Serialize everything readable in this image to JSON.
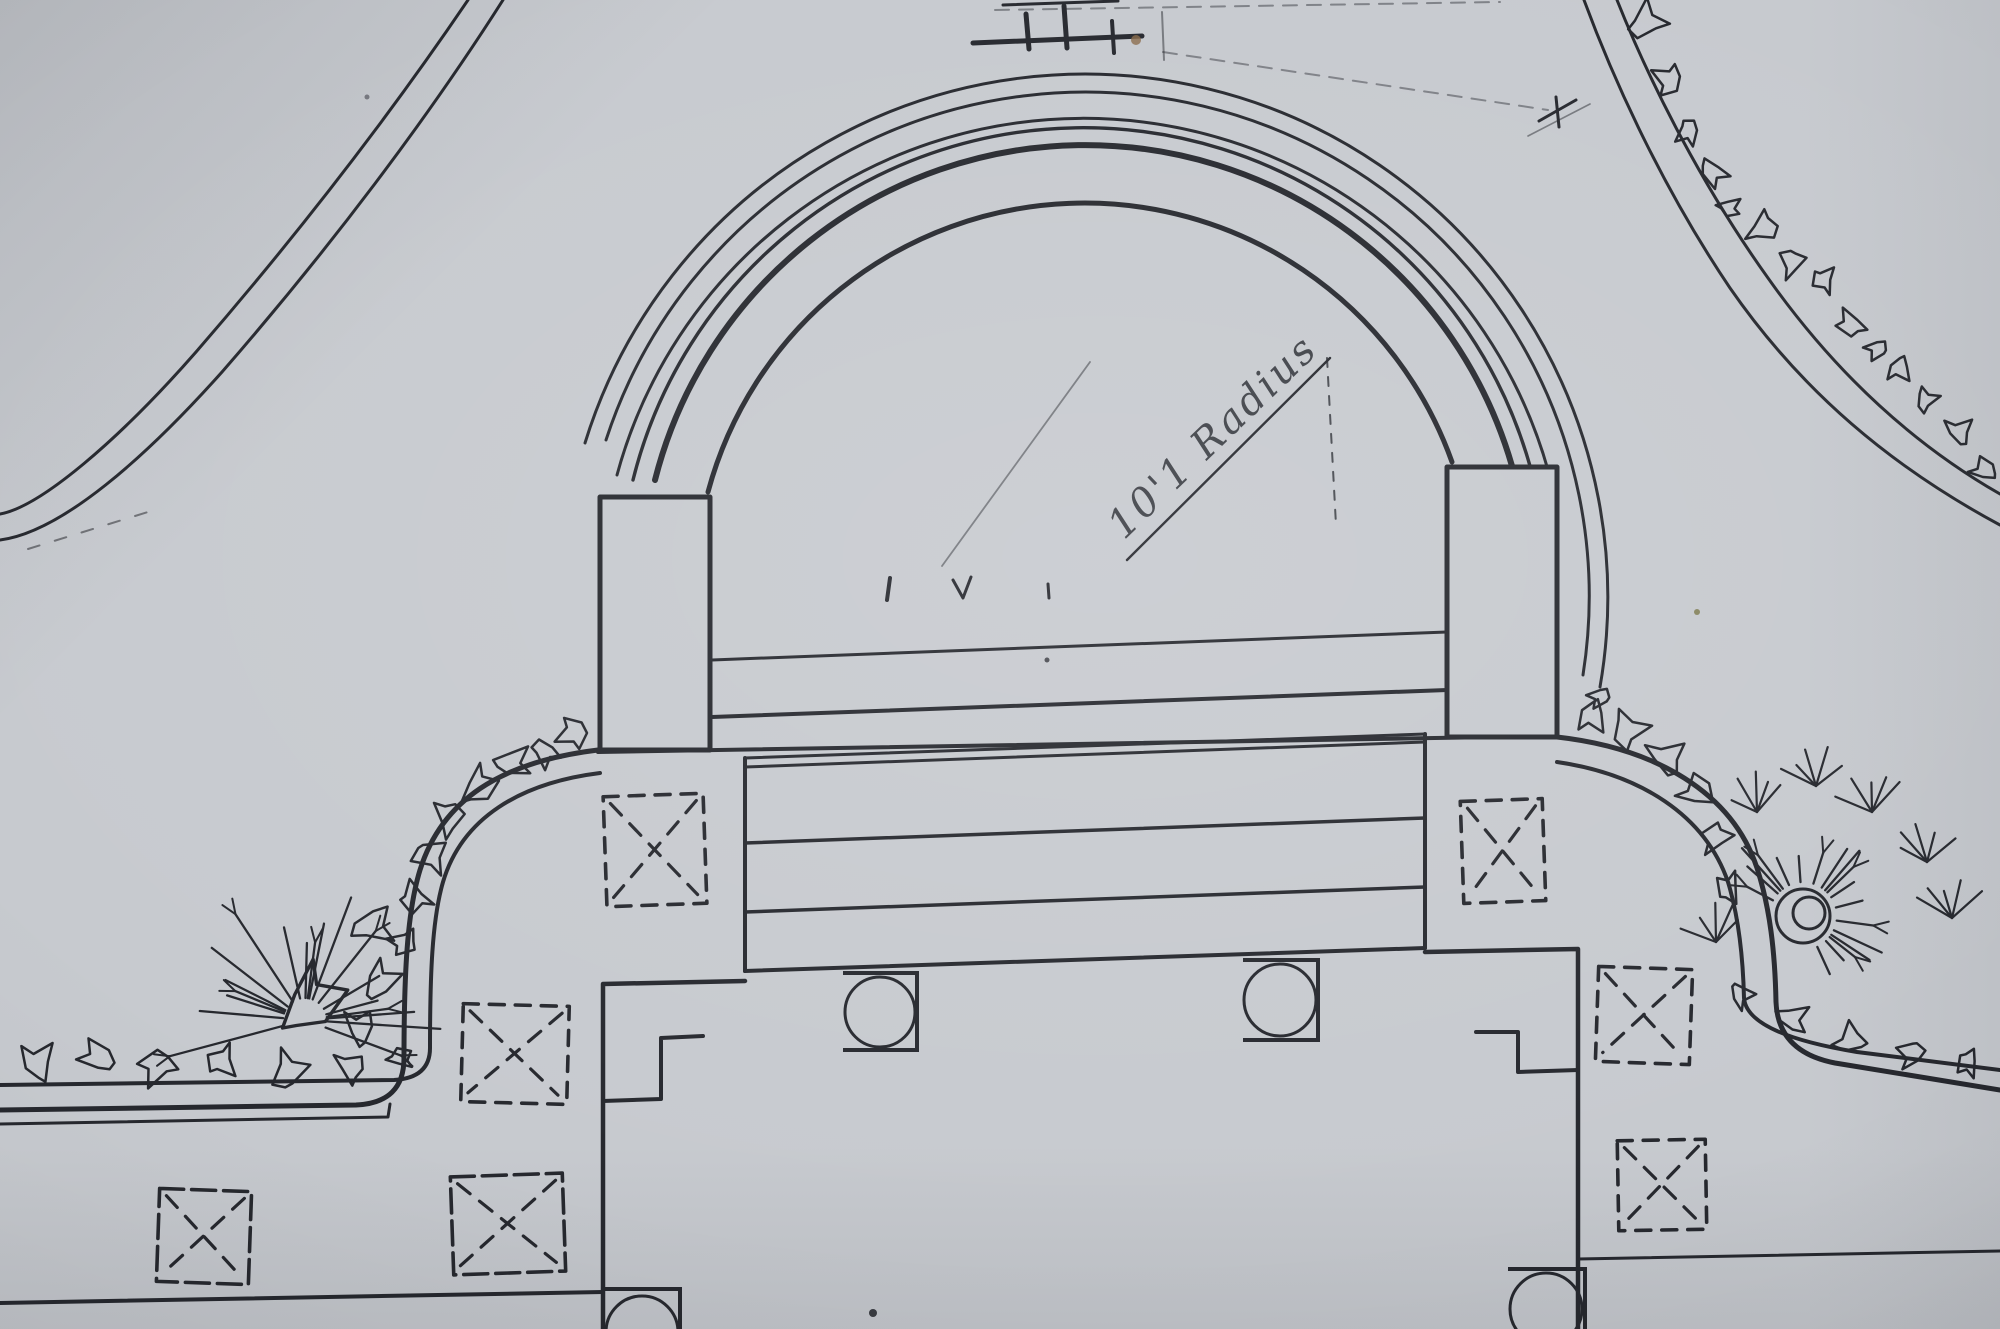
{
  "meta": {
    "description": "photograph of a hand-drawn landscape architecture site plan: semicircular amphitheater terrace with steps, pillars, curved walls, planting squares, boulders and shrubs",
    "paper_color": "#c7cacf",
    "ink_color": "#26282e",
    "thin_ink_color": "#33363d",
    "faint_ink_color": "#585c66",
    "smudge_color": "#8a6a4a",
    "olive_speck_color": "#7c7a4e"
  },
  "annotation": {
    "text": "10'1 Radius",
    "x": 1222,
    "y": 446,
    "rotation_deg": -44,
    "font_size": 40
  },
  "drawing": {
    "paths": [
      {
        "name": "swale-curve-outer",
        "d": "M 468,0 C 392,112 300,232 196,352 C 118,441 40,507 0,514",
        "w": 3
      },
      {
        "name": "swale-curve-inner",
        "d": "M 503,0 C 428,118 330,248 222,372 C 146,457 62,532 0,540",
        "w": 3
      },
      {
        "name": "swale-curve-dash",
        "d": "M 28,549 L 148,512",
        "w": 2,
        "dash": "12 16",
        "op": 0.55
      },
      {
        "name": "topright-path-outer",
        "d": "M 1617,0 C 1652,88 1705,190 1768,278 C 1838,377 1918,447 2000,494",
        "w": 3
      },
      {
        "name": "topright-path-inner",
        "d": "M 1584,0 C 1618,92 1668,196 1730,288 C 1802,392 1892,467 2000,525",
        "w": 3
      },
      {
        "name": "amphitheater-arc-1",
        "d": "M 585,443 A 523 523 0 0 1 1600,687",
        "w": 3
      },
      {
        "name": "amphitheater-arc-2",
        "d": "M 606,440 A 504 504 0 0 1 1583,675",
        "w": 3
      },
      {
        "name": "amphitheater-arc-3",
        "d": "M 617,475 A 483 483 0 0 1 1548,470",
        "w": 3
      },
      {
        "name": "amphitheater-arc-4",
        "d": "M 633,480 A 464 464 0 0 1 1530,466",
        "w": 3.4
      },
      {
        "name": "amphitheater-arc-5",
        "d": "M 655,480 A 444 444 0 0 1 1512,466",
        "w": 6
      },
      {
        "name": "amphitheater-arc-6",
        "d": "M 708,492 A 390 390 0 0 1 1452,462",
        "w": 5
      },
      {
        "name": "stage-front-edge",
        "d": "M 598,752 L 1557,736",
        "w": 4
      },
      {
        "name": "stage-step-line-1",
        "d": "M 712,660 L 1447,632",
        "w": 3
      },
      {
        "name": "stage-step-line-2",
        "d": "M 712,717 L 1447,690",
        "w": 4
      },
      {
        "name": "terrace-left-edge",
        "d": "M 745,758 L 745,971",
        "w": 4
      },
      {
        "name": "terrace-top-edge",
        "d": "M 745,758 L 1425,734",
        "w": 3
      },
      {
        "name": "terrace-right-edge",
        "d": "M 1425,734 L 1425,948",
        "w": 4
      },
      {
        "name": "terrace-bottom-edge",
        "d": "M 745,971 L 1425,948",
        "w": 4
      },
      {
        "name": "terrace-step-line-1",
        "d": "M 745,767 L 1425,742",
        "w": 3
      },
      {
        "name": "terrace-step-line-2",
        "d": "M 745,843 L 1425,818",
        "w": 3.5
      },
      {
        "name": "terrace-step-line-3",
        "d": "M 745,912 L 1425,887",
        "w": 3.5
      },
      {
        "name": "left-stepped-wall",
        "d": "M 745,981 L 603,984 L 603,1329",
        "w": 4.5
      },
      {
        "name": "left-wall-notch",
        "d": "M 703,1036 L 661,1038 L 661,1099 L 603,1101",
        "w": 4
      },
      {
        "name": "right-stepped-wall",
        "d": "M 1425,952 L 1578,949 L 1578,1329",
        "w": 4.5
      },
      {
        "name": "right-wall-notch",
        "d": "M 1476,1032 L 1518,1032 L 1518,1072 L 1578,1070",
        "w": 4
      },
      {
        "name": "left-curved-wall-outer",
        "d": "M 598,750 C 500,762 442,800 420,870 C 407,912 404,975 404,1058 Q 404,1103 356,1105 L 0,1110",
        "w": 5
      },
      {
        "name": "left-curved-wall-inner",
        "d": "M 600,773 C 520,783 462,818 443,882 C 432,920 430,975 430,1048 Q 430,1078 394,1080 L 0,1085",
        "w": 4
      },
      {
        "name": "right-curved-wall-outer",
        "d": "M 1557,737 C 1655,748 1732,792 1757,868 C 1770,908 1775,952 1776,1002 Q 1778,1052 1835,1063 L 2000,1090",
        "w": 5
      },
      {
        "name": "right-curved-wall-inner",
        "d": "M 1557,762 C 1640,774 1705,815 1728,882 C 1739,918 1743,957 1744,998 Q 1747,1034 1857,1052 L 2000,1070",
        "w": 4
      },
      {
        "name": "left-path-line",
        "d": "M 0,1124 L 388,1117 L 390,1104",
        "w": 3
      },
      {
        "name": "bottom-line-left",
        "d": "M 0,1303 L 603,1292",
        "w": 4
      },
      {
        "name": "bottom-line-right",
        "d": "M 1578,1259 L 2000,1251",
        "w": 3
      },
      {
        "name": "radius-leader-line",
        "d": "M 1127,560 L 1330,358",
        "w": 2.4
      },
      {
        "name": "radius-extension-dash",
        "d": "M 1327,358 L 1336,525",
        "w": 2,
        "dash": "9 10",
        "op": 0.8
      },
      {
        "name": "radius-construction-line",
        "d": "M 942,566 L 1090,362",
        "w": 1.8,
        "op": 0.5
      },
      {
        "name": "top-mark-bar",
        "d": "M 973,43 L 1142,36",
        "w": 5
      },
      {
        "name": "top-mark-tick-1",
        "d": "M 1026,14 L 1029,49",
        "w": 5
      },
      {
        "name": "top-mark-tick-2",
        "d": "M 1064,6 L 1067,48",
        "w": 5
      },
      {
        "name": "top-mark-tick-3",
        "d": "M 1112,21 L 1114,53",
        "w": 4
      },
      {
        "name": "top-mark-dash",
        "d": "M 1003,5 L 1118,1",
        "w": 3
      },
      {
        "name": "top-construction-dash-a",
        "d": "M 995,10 L 1500,2",
        "w": 2,
        "dash": "14 10",
        "op": 0.45
      },
      {
        "name": "top-construction-dash-b",
        "d": "M 1163,52 L 1548,110",
        "w": 2,
        "dash": "14 10",
        "op": 0.45
      },
      {
        "name": "top-construction-tick",
        "d": "M 1162,12 L 1164,60",
        "w": 2,
        "op": 0.5
      },
      {
        "name": "topright-cross-mark-1",
        "d": "M 1539,121 L 1576,100",
        "w": 3
      },
      {
        "name": "topright-cross-mark-2",
        "d": "M 1556,97 L 1559,127",
        "w": 3
      },
      {
        "name": "topright-cross-faint",
        "d": "M 1528,136 L 1590,104",
        "w": 1.6,
        "op": 0.5
      },
      {
        "name": "stage-tick-1",
        "d": "M 887,600 L 890,578",
        "w": 4
      },
      {
        "name": "stage-v-mark",
        "d": "M 953,580 L 963,598 L 971,577",
        "w": 3
      },
      {
        "name": "stage-tick-2",
        "d": "M 1048,584 L 1049,598",
        "w": 3
      }
    ],
    "pillars": [
      {
        "name": "left-pillar",
        "x": 600,
        "y": 497,
        "w": 110,
        "h": 253
      },
      {
        "name": "right-pillar",
        "x": 1447,
        "y": 467,
        "w": 110,
        "h": 270
      }
    ],
    "planters": [
      {
        "name": "planter-upper-left",
        "x": 605,
        "y": 795,
        "w": 100,
        "h": 110,
        "rot": -2,
        "style": "a"
      },
      {
        "name": "planter-lower-left",
        "x": 462,
        "y": 1005,
        "w": 106,
        "h": 98,
        "rot": 1.5,
        "style": "a"
      },
      {
        "name": "planter-upper-right",
        "x": 1462,
        "y": 800,
        "w": 82,
        "h": 102,
        "rot": -2,
        "style": "a"
      },
      {
        "name": "planter-mid-right",
        "x": 1597,
        "y": 968,
        "w": 94,
        "h": 95,
        "rot": 2,
        "style": "a"
      },
      {
        "name": "planter-lower-right",
        "x": 1618,
        "y": 1140,
        "w": 88,
        "h": 90,
        "rot": -1,
        "style": "a"
      },
      {
        "name": "planter-bottom-left-1",
        "x": 158,
        "y": 1190,
        "w": 92,
        "h": 93,
        "rot": 2,
        "style": "b"
      },
      {
        "name": "planter-bottom-left-2",
        "x": 452,
        "y": 1175,
        "w": 112,
        "h": 98,
        "rot": -2,
        "style": "b"
      }
    ],
    "columns": [
      {
        "name": "column-left",
        "sx": 843,
        "sy": 973,
        "sw": 74,
        "sh": 77,
        "cx": 880,
        "cy": 1012,
        "r": 35
      },
      {
        "name": "column-right",
        "sx": 1243,
        "sy": 960,
        "sw": 75,
        "sh": 80,
        "cx": 1280,
        "cy": 1000,
        "r": 36
      },
      {
        "name": "column-bottom-left",
        "sx": 604,
        "sy": 1289,
        "sw": 76,
        "sh": 52,
        "cx": 642,
        "cy": 1332,
        "r": 36
      },
      {
        "name": "column-bottom-right",
        "sx": 1508,
        "sy": 1269,
        "sw": 77,
        "sh": 64,
        "cx": 1546,
        "cy": 1309,
        "r": 36
      }
    ],
    "rock_groups": [
      {
        "name": "rocks-left-curve",
        "rocks": [
          [
            573,
            733,
            20
          ],
          [
            545,
            752,
            18
          ],
          [
            512,
            762,
            22
          ],
          [
            478,
            787,
            24
          ],
          [
            449,
            818,
            22
          ],
          [
            430,
            856,
            22
          ],
          [
            415,
            898,
            20
          ],
          [
            404,
            942,
            18
          ]
        ]
      },
      {
        "name": "rocks-left-inner",
        "rocks": [
          [
            372,
            926,
            26
          ],
          [
            380,
            982,
            24
          ],
          [
            360,
            1028,
            22
          ]
        ]
      },
      {
        "name": "rocks-left-bottom-row",
        "rocks": [
          [
            38,
            1062,
            24
          ],
          [
            98,
            1057,
            22
          ],
          [
            158,
            1066,
            24
          ],
          [
            222,
            1061,
            20
          ],
          [
            288,
            1071,
            24
          ],
          [
            350,
            1067,
            20
          ],
          [
            400,
            1058,
            15
          ]
        ]
      },
      {
        "name": "rocks-right-curve",
        "rocks": [
          [
            1600,
            697,
            14
          ],
          [
            1592,
            716,
            20
          ],
          [
            1628,
            730,
            24
          ],
          [
            1666,
            757,
            24
          ],
          [
            1697,
            792,
            22
          ],
          [
            1716,
            838,
            20
          ],
          [
            1729,
            888,
            18
          ]
        ]
      },
      {
        "name": "rocks-right-lower-band",
        "rocks": [
          [
            1741,
            995,
            16
          ],
          [
            1792,
            1018,
            20
          ],
          [
            1850,
            1040,
            20
          ],
          [
            1912,
            1054,
            18
          ],
          [
            1968,
            1063,
            16
          ]
        ]
      },
      {
        "name": "rocks-topright-chain",
        "rocks": [
          [
            1646,
            22,
            24
          ],
          [
            1669,
            80,
            20
          ],
          [
            1688,
            132,
            16
          ],
          [
            1713,
            172,
            18
          ],
          [
            1729,
            207,
            14
          ],
          [
            1762,
            228,
            20
          ],
          [
            1792,
            263,
            18
          ],
          [
            1824,
            280,
            16
          ],
          [
            1851,
            324,
            18
          ],
          [
            1877,
            349,
            14
          ],
          [
            1899,
            369,
            16
          ],
          [
            1926,
            400,
            15
          ],
          [
            1959,
            431,
            18
          ],
          [
            1984,
            470,
            16
          ]
        ]
      }
    ],
    "shrubs": [
      {
        "name": "shrub-left",
        "cx": 305,
        "cy": 1020,
        "blob_r": 42,
        "blob_dx": 5,
        "blob_dy": -18,
        "rays": {
          "n": 19,
          "a0": -195,
          "a1": 25,
          "r0": 22,
          "r1": 140
        },
        "circles": []
      },
      {
        "name": "shrub-right",
        "cx": 1803,
        "cy": 916,
        "blob_r": 0,
        "rays": {
          "n": 18,
          "a0": -160,
          "a1": 70,
          "r0": 34,
          "r1": 92
        },
        "circles": [
          27,
          16
        ],
        "tufts": [
          [
            1757,
            812
          ],
          [
            1816,
            786
          ],
          [
            1872,
            812
          ],
          [
            1927,
            862
          ],
          [
            1716,
            942
          ],
          [
            1952,
            918
          ]
        ]
      }
    ],
    "specks": [
      {
        "x": 1136,
        "y": 40,
        "r": 5,
        "c": "#8a6a4a",
        "op": 0.8,
        "name": "brown-smudge"
      },
      {
        "x": 873,
        "y": 1313,
        "r": 4,
        "c": "#2a2c32",
        "op": 0.9,
        "name": "ink-dot"
      },
      {
        "x": 1697,
        "y": 612,
        "r": 3,
        "c": "#7c7a4e",
        "op": 0.85,
        "name": "olive-speck"
      },
      {
        "x": 1047,
        "y": 660,
        "r": 2.5,
        "c": "#2a2c32",
        "op": 0.8,
        "name": "ink-speck"
      },
      {
        "x": 367,
        "y": 97,
        "r": 2.5,
        "c": "#44464e",
        "op": 0.6,
        "name": "paper-speck"
      }
    ]
  }
}
